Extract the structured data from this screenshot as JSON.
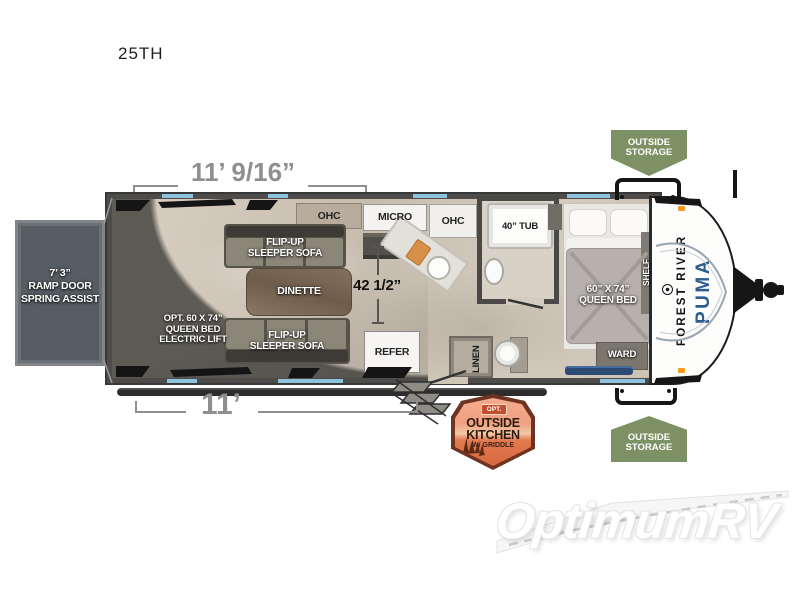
{
  "title": "25TH",
  "dimensions": {
    "top_width": "11’ 9/16”",
    "bottom_width": "11’",
    "kitchen_clearance": "42 1/2”"
  },
  "ramp_door": {
    "label": "7’ 3”\nRAMP DOOR\nSPRING ASSIST"
  },
  "garage": {
    "opt_bed_label": "OPT. 60 X 74”\nQUEEN BED\nELECTRIC LIFT",
    "ohc_label": "OHC",
    "sofa_top_label": "FLIP-UP\nSLEEPER SOFA",
    "dinette_label": "DINETTE",
    "sofa_bottom_label": "FLIP-UP\nSLEEPER SOFA"
  },
  "kitchen": {
    "micro_label": "MICRO",
    "ohc_label": "OHC",
    "refer_label": "REFER"
  },
  "bathroom": {
    "tub_label": "40” TUB",
    "linen_label": "LINEN"
  },
  "bedroom": {
    "bed_label": "60” X 74”\nQUEEN BED",
    "shelf_label": "SHELF",
    "ward_label": "WARD"
  },
  "badges": {
    "outside_storage_top": "OUTSIDE\nSTORAGE",
    "outside_storage_bottom": "OUTSIDE\nSTORAGE",
    "outside_kitchen": {
      "opt": "OPT.",
      "line1": "OUTSIDE",
      "line2": "KITCHEN",
      "line3": "W/ GRIDDLE"
    }
  },
  "brand": {
    "manufacturer": "FOREST RIVER",
    "model": "PUMA"
  },
  "watermark": "OptimumRV",
  "colors": {
    "wall": "#4d4c4a",
    "floor": "#cfc6b8",
    "garage_shadow": "#5e5b55",
    "storage_badge_green": "#7e9164",
    "outside_kitchen_orange": "#e07a50",
    "window_accent_blue": "#8fc2de",
    "brand_blue": "#2d5d8d",
    "dimension_text_gray": "#8f8f8f"
  }
}
